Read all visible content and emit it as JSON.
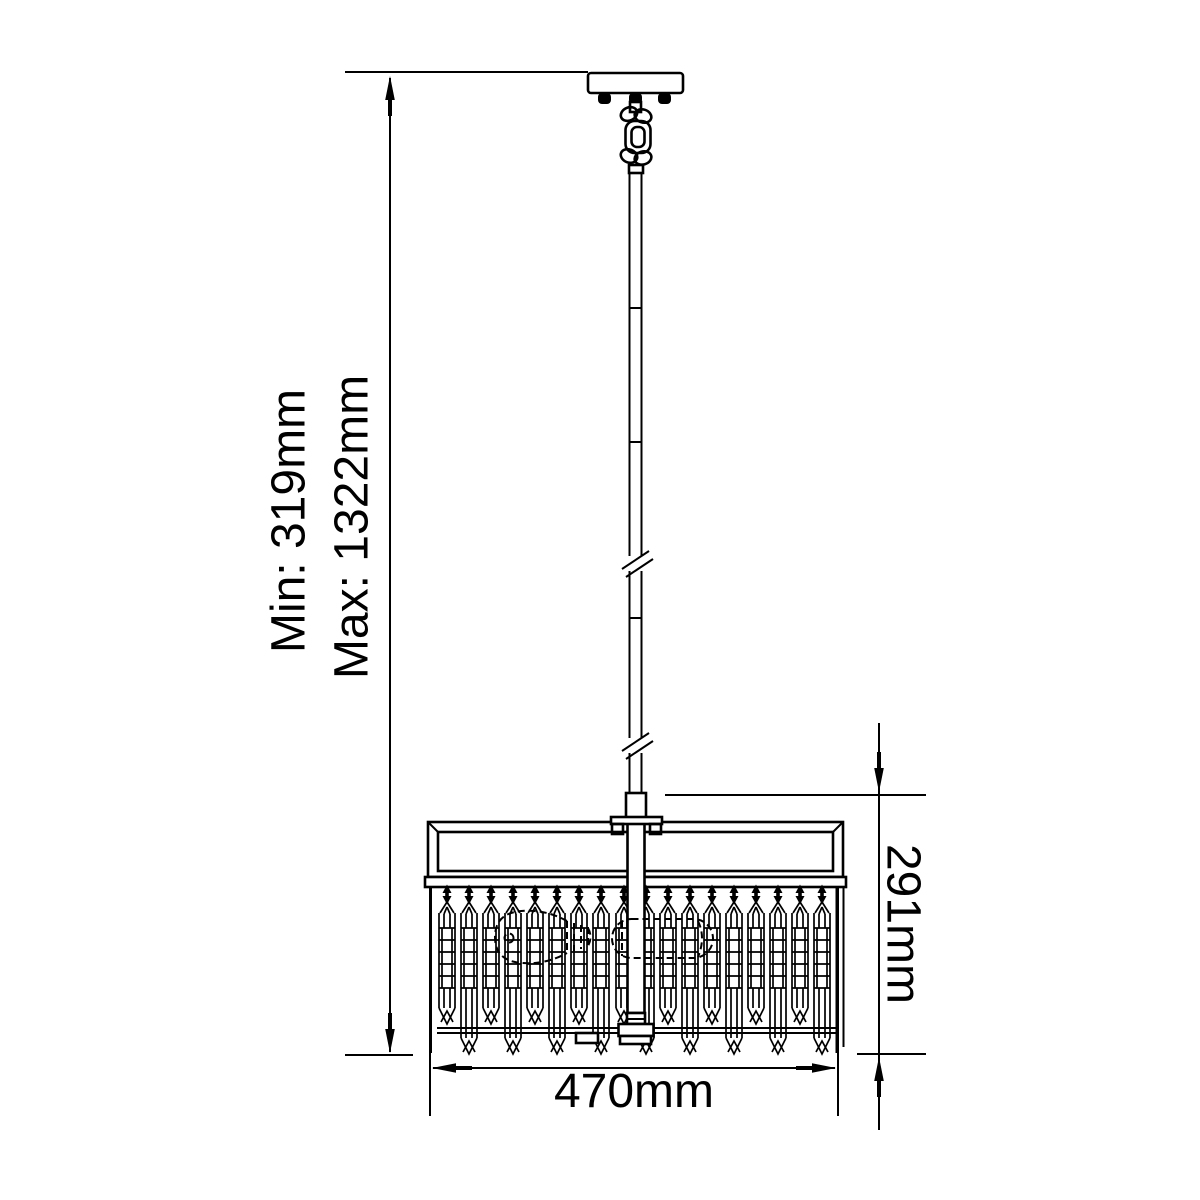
{
  "canvas": {
    "background_color": "#ffffff",
    "line_color": "#000000",
    "text_color": "#000000"
  },
  "labels": {
    "min_height": "Min: 319mm",
    "max_height": "Max: 1322mm",
    "body_height": "291mm",
    "width": "470mm"
  },
  "values": {
    "min_height_mm": 319,
    "max_height_mm": 1322,
    "body_height_mm": 291,
    "width_mm": 470,
    "unit": "mm"
  }
}
